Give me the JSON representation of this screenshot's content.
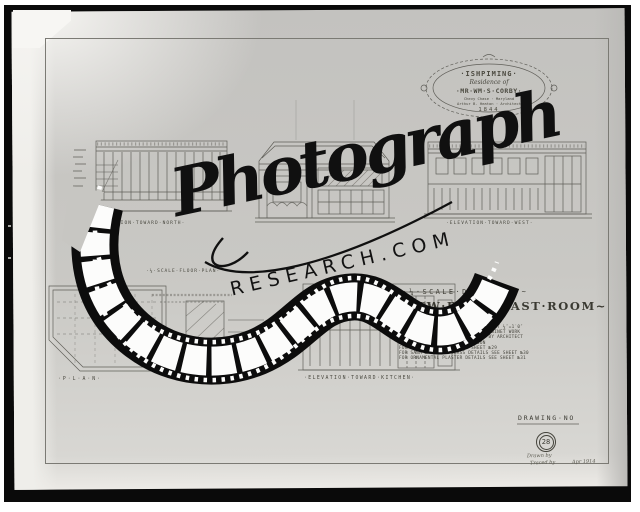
{
  "colors": {
    "frame": "#0a0a0a",
    "sheet": "#c7c6c2",
    "ink": "#4b4a44",
    "watermark": "#101010"
  },
  "watermark": {
    "script": "Photograph",
    "caps": "RESEARCH.COM"
  },
  "cartouche": {
    "estate": "·ISHPIMING·",
    "line2": "Residence of",
    "owner": "·MR·WM·S·CORBY·",
    "line4": "Chevy Chase · Maryland",
    "line5": "Arthur B. Heaton · Architect",
    "number": "1844"
  },
  "labels": {
    "elev_north": "·ELEVATION·TOWARD·NORTH·",
    "elev_west": "·ELEVATION·TOWARD·WEST·",
    "plan_scale": "·¼·SCALE·FLOOR·PLAN·",
    "plan": "·P·L·A·N·",
    "elev_kitchen": "·ELEVATION·TOWARD·KITCHEN·"
  },
  "title_block": {
    "heading_small": "~·¼·SCALE·DRAWINGS·~",
    "heading_main": "~NEW·BREAKFAST·ROOM~",
    "notes": [
      "SCALE OF ALL DRAWINGS ON THIS SHEET ¼″=1′0″",
      "ALL WOOD FINISH TO BE OF BEST CABINET WORK",
      "SAME TO BE FROM WOODS APPROVED BY ARCHITECT",
      "AND DONE UNDER HIS SUPERVISION",
      "FOR MILLWORK DETAILS SEE SHEET №29",
      "FOR SASH & LEADED GLASS DETAILS SEE SHEET №30",
      "FOR ORNAMENTAL PLASTER DETAILS SEE SHEET №31"
    ]
  },
  "number_block": {
    "label": "DRAWING·NO",
    "number": "28",
    "drawn": "Drawn by",
    "traced": "Traced by",
    "date": "Apr 1914"
  }
}
